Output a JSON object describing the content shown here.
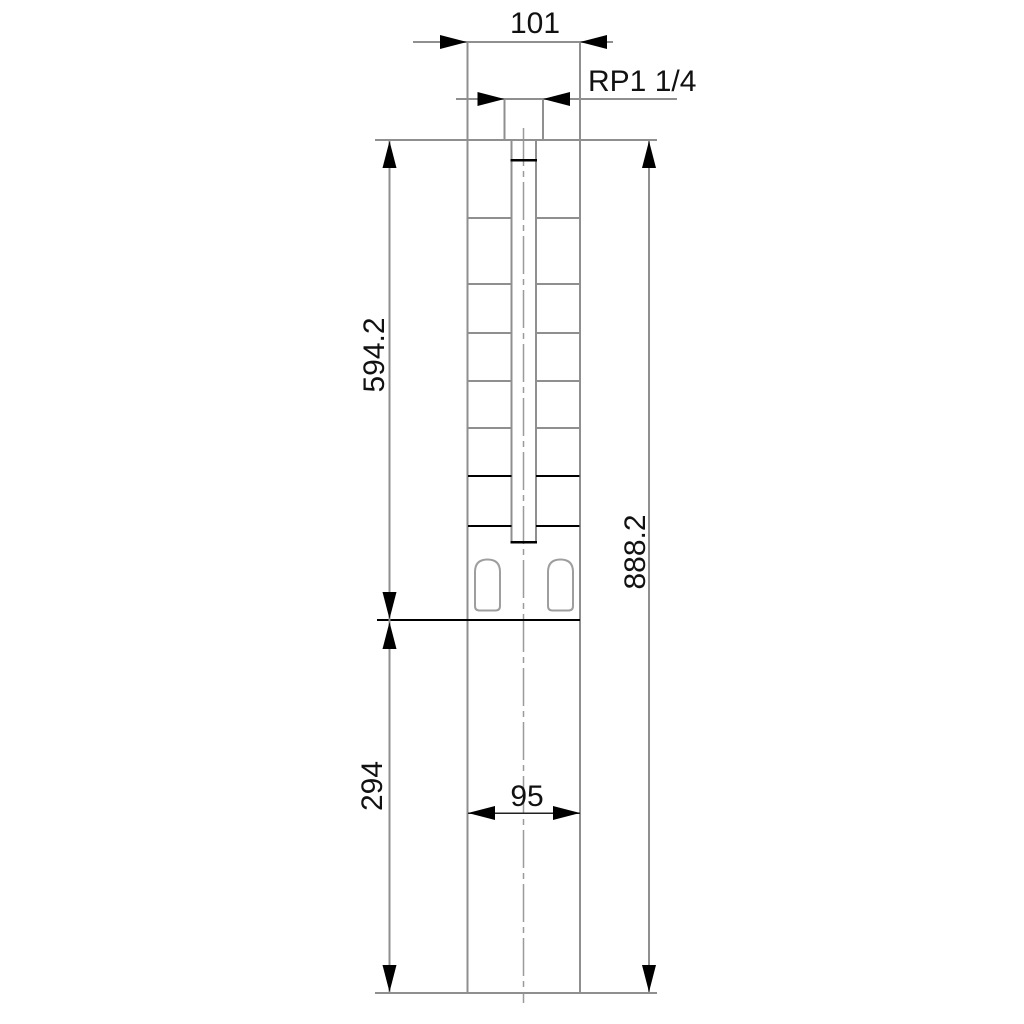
{
  "drawing": {
    "kind": "technical-dimension-drawing",
    "subject": "submersible borehole pump outline, front view",
    "colors": {
      "background": "#ffffff",
      "outline_gray": "#8f8f8f",
      "slot_gray": "#9e9e9e",
      "emphasis_black": "#000000",
      "text": "#111111"
    },
    "labels": {
      "width_top": "101",
      "thread": "RP1 1/4",
      "pump_section_length": "594.2",
      "total_length": "888.2",
      "motor_section_length": "294",
      "width_bottom": "95"
    }
  }
}
